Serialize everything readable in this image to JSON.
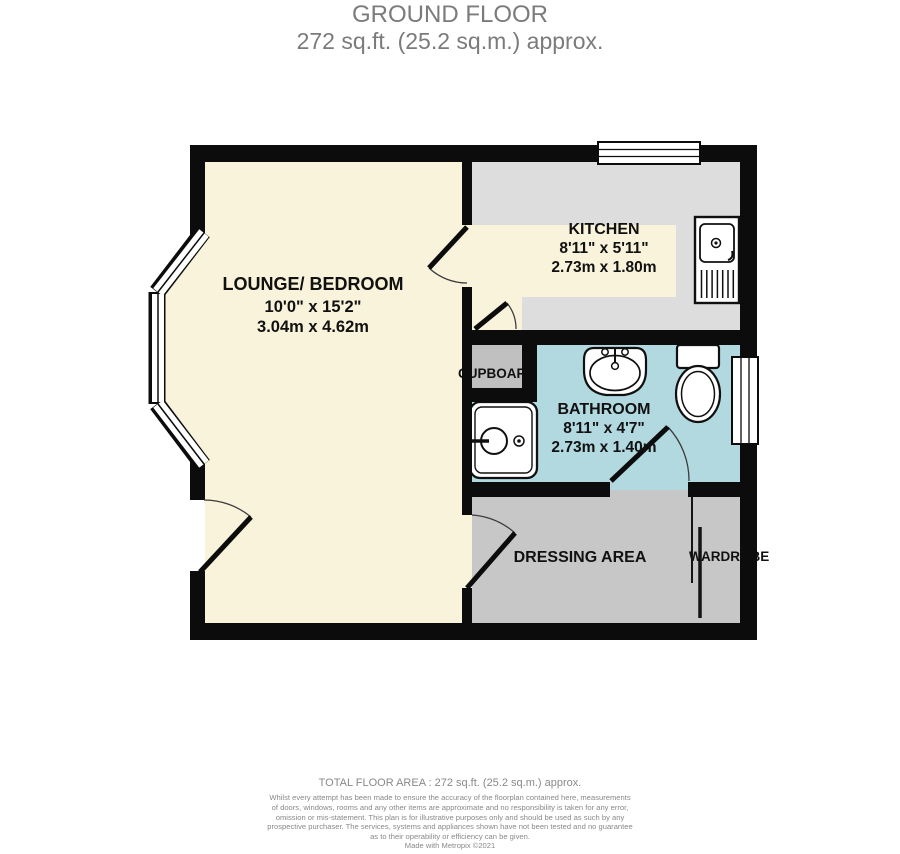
{
  "header": {
    "title": "GROUND FLOOR",
    "subtitle": "272 sq.ft. (25.2 sq.m.) approx."
  },
  "rooms": {
    "lounge": {
      "name": "LOUNGE/ BEDROOM",
      "imperial": "10'0\"  x 15'2\"",
      "metric": "3.04m  x 4.62m"
    },
    "kitchen": {
      "name": "KITCHEN",
      "imperial": "8'11\"  x 5'11\"",
      "metric": "2.73m  x 1.80m"
    },
    "bathroom": {
      "name": "BATHROOM",
      "imperial": "8'11\"  x 4'7\"",
      "metric": "2.73m  x 1.40m"
    },
    "cupboard": {
      "name": "CUPBOARD"
    },
    "dressing": {
      "name": "DRESSING AREA"
    },
    "wardrobe": {
      "name": "WARDROBE"
    }
  },
  "fixtures": {
    "kitchen_sink": "kitchen-sink-icon",
    "basin": "basin-icon",
    "toilet": "toilet-icon",
    "shower_tray": "shower-tray-icon",
    "bay_window": "bay-window",
    "kitchen_window": "kitchen-window",
    "bathroom_window": "bathroom-window"
  },
  "colors": {
    "wall": "#0c0c0c",
    "lounge_floor": "#f8f3da",
    "kitchen_floor": "#dddddd",
    "kitchen_worktop": "#f8f3da",
    "bathroom_floor": "#b2d9e0",
    "cupboard_floor": "#c0c0c0",
    "dressing_floor": "#c7c7c7",
    "title_text": "#7b7b7b",
    "footer_text": "#898989"
  },
  "footer": {
    "total_area": "TOTAL FLOOR AREA : 272 sq.ft. (25.2 sq.m.) approx.",
    "disclaimer_lines": [
      "Whilst every attempt has been made to ensure the accuracy of the floorplan contained here, measurements",
      "of doors, windows, rooms and any other items are approximate and no responsibility is taken for any error,",
      "omission or mis-statement. This plan is for illustrative purposes only and should be used as such by any",
      "prospective purchaser. The services, systems and appliances shown have not been tested and no guarantee",
      "as to their operability or efficiency can be given.",
      "Made with Metropix ©2021"
    ]
  }
}
